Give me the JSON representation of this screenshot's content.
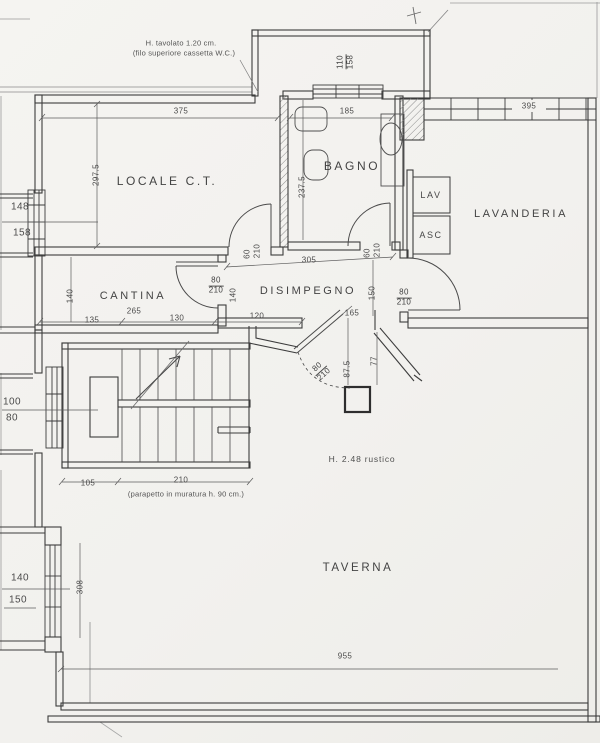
{
  "rooms": {
    "locale_ct": "LOCALE C.T.",
    "bagno": "BAGNO",
    "lavanderia": "LAVANDERIA",
    "cantina": "CANTINA",
    "disimpegno": "DISIMPEGNO",
    "taverna": "TAVERNA"
  },
  "appliances": {
    "washer": "LAV",
    "dryer": "ASC"
  },
  "notes": {
    "wc_1": "H. tavolato 1.20 cm.",
    "wc_2": "(filo superiore cassetta W.C.)",
    "height": "H. 2.48 rustico",
    "parapet": "(parapetto in muratura h. 90 cm.)"
  },
  "windows": {
    "bay": {
      "w": "110",
      "h": "158"
    },
    "left1": {
      "w": "148",
      "h": "158"
    },
    "left2": {
      "w": "100",
      "h": "80"
    },
    "left3": {
      "w": "140",
      "h": "150"
    }
  },
  "doors": {
    "cantina": {
      "w": "80",
      "h": "210",
      "side": "140"
    },
    "corridor": {
      "w": "60",
      "h": "210"
    },
    "bagno": {
      "w": "60",
      "h": "210"
    },
    "lavanderia": {
      "w": "80",
      "h": "210"
    },
    "taverna": {
      "w": "80",
      "h": "210"
    }
  },
  "dims": {
    "locale_w": "375",
    "locale_d": "297.5",
    "bagno_w": "185",
    "bagno_d": "237.5",
    "band_395": "395",
    "cantina_w": "265",
    "cantina_d": "140",
    "seg_135": "135",
    "seg_130": "130",
    "seg_120": "120",
    "seg_165": "165",
    "dis_w": "305",
    "dis_d": "150",
    "col_a": "87.5",
    "col_b": "77",
    "stair_a": "105",
    "stair_b": "210",
    "wall_side": "308",
    "taverna_w": "955"
  }
}
